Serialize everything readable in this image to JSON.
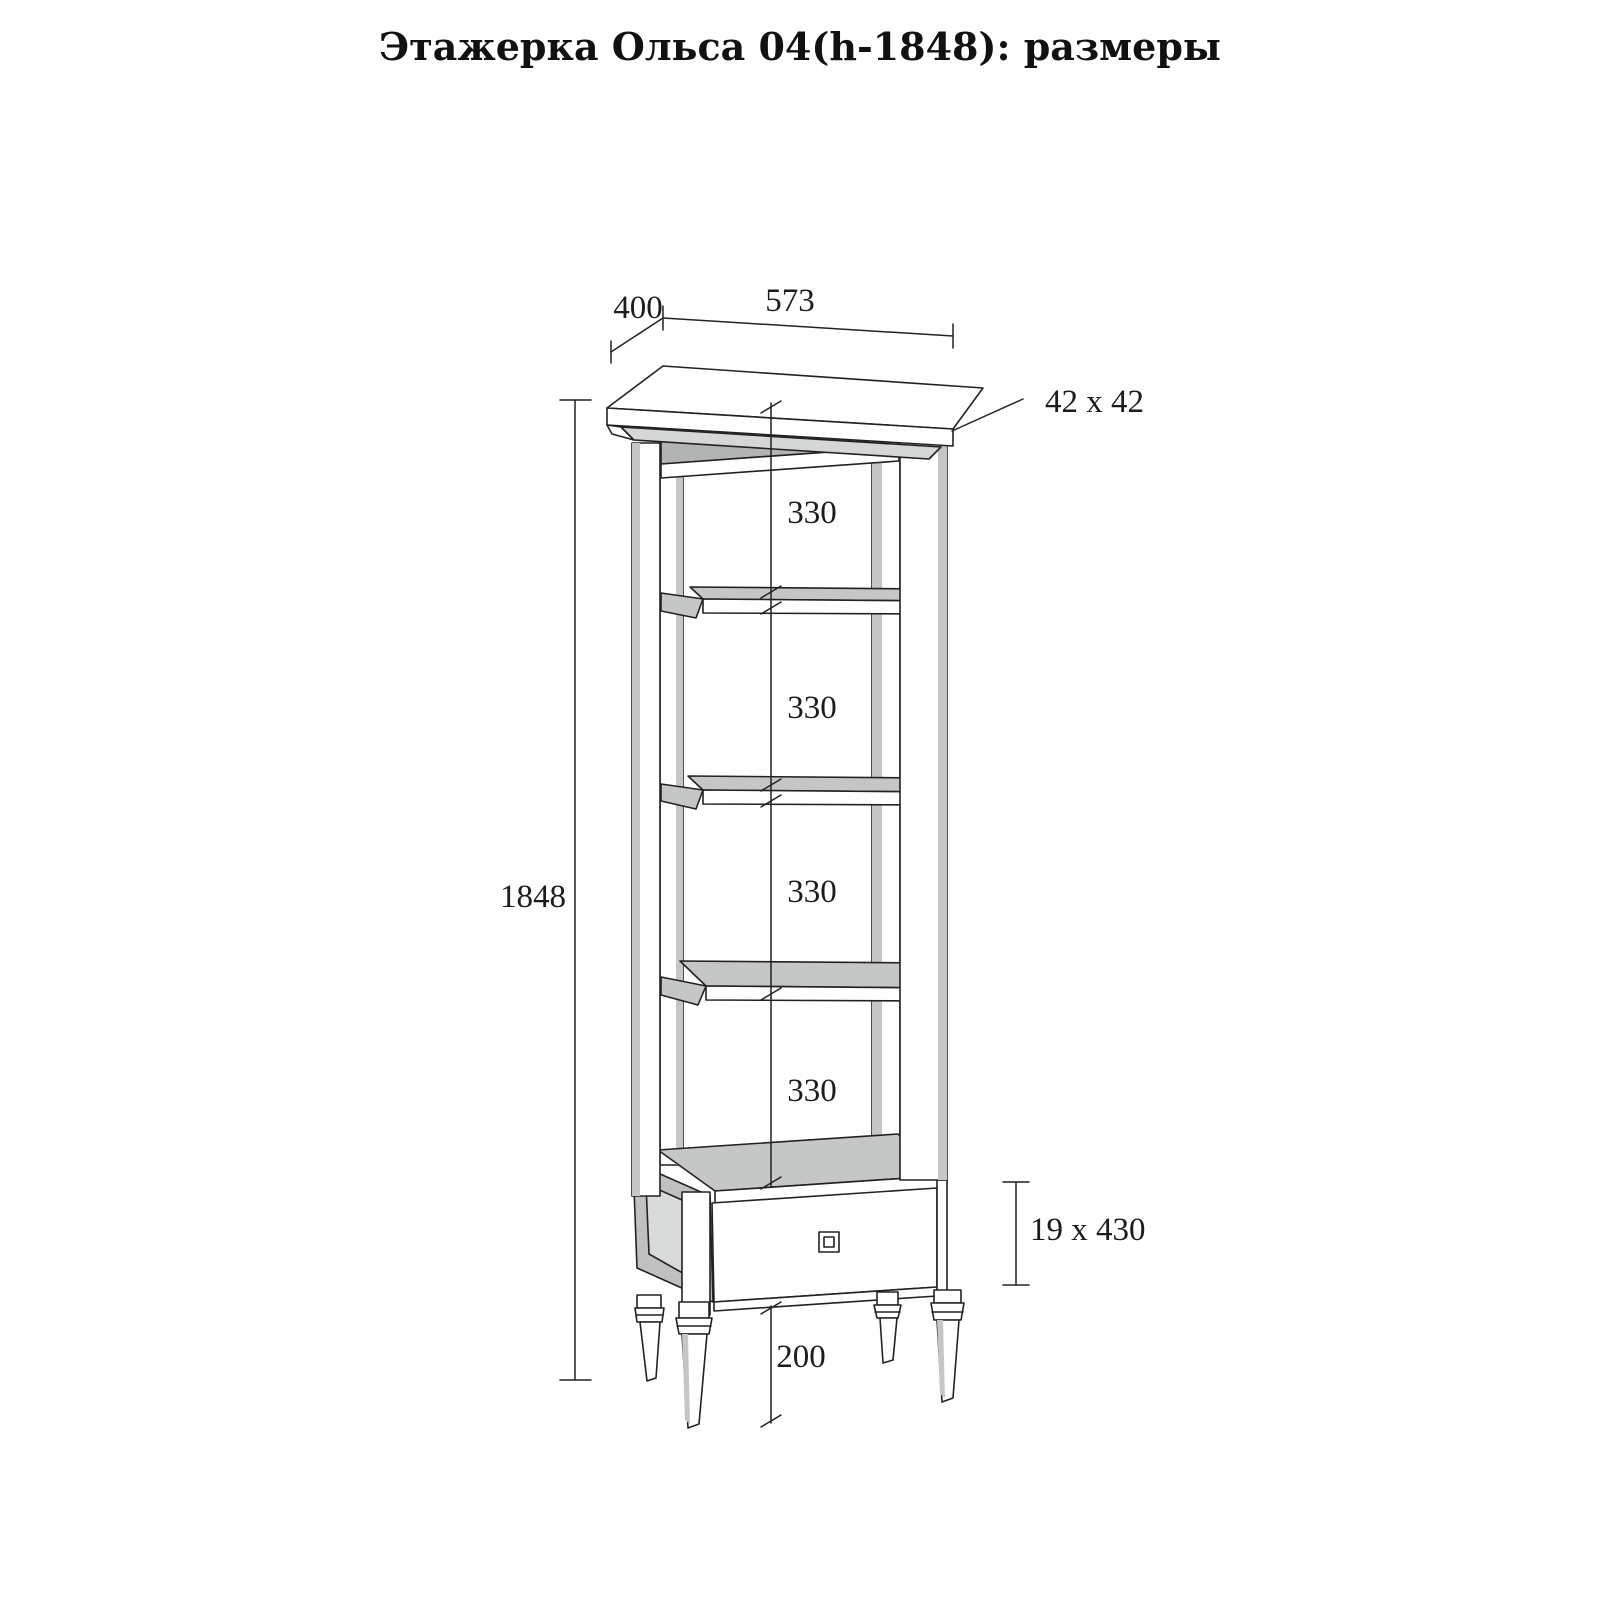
{
  "title": "Этажерка Ольса 04(h-1848): размеры",
  "diagram": {
    "dim_width_top": "573",
    "dim_depth_top": "400",
    "dim_post_section": "42 x 42",
    "dim_total_height": "1848",
    "dim_shelf_gaps": [
      "330",
      "330",
      "330",
      "330"
    ],
    "dim_drawer_section": "19 x 430",
    "dim_leg_height": "200"
  },
  "colors": {
    "line": "#222222",
    "surface_gray": "#c5c7c6",
    "inner_shadow_gray": "#b2b4b3",
    "cove_gray": "#d5d7d6",
    "background": "#ffffff"
  }
}
